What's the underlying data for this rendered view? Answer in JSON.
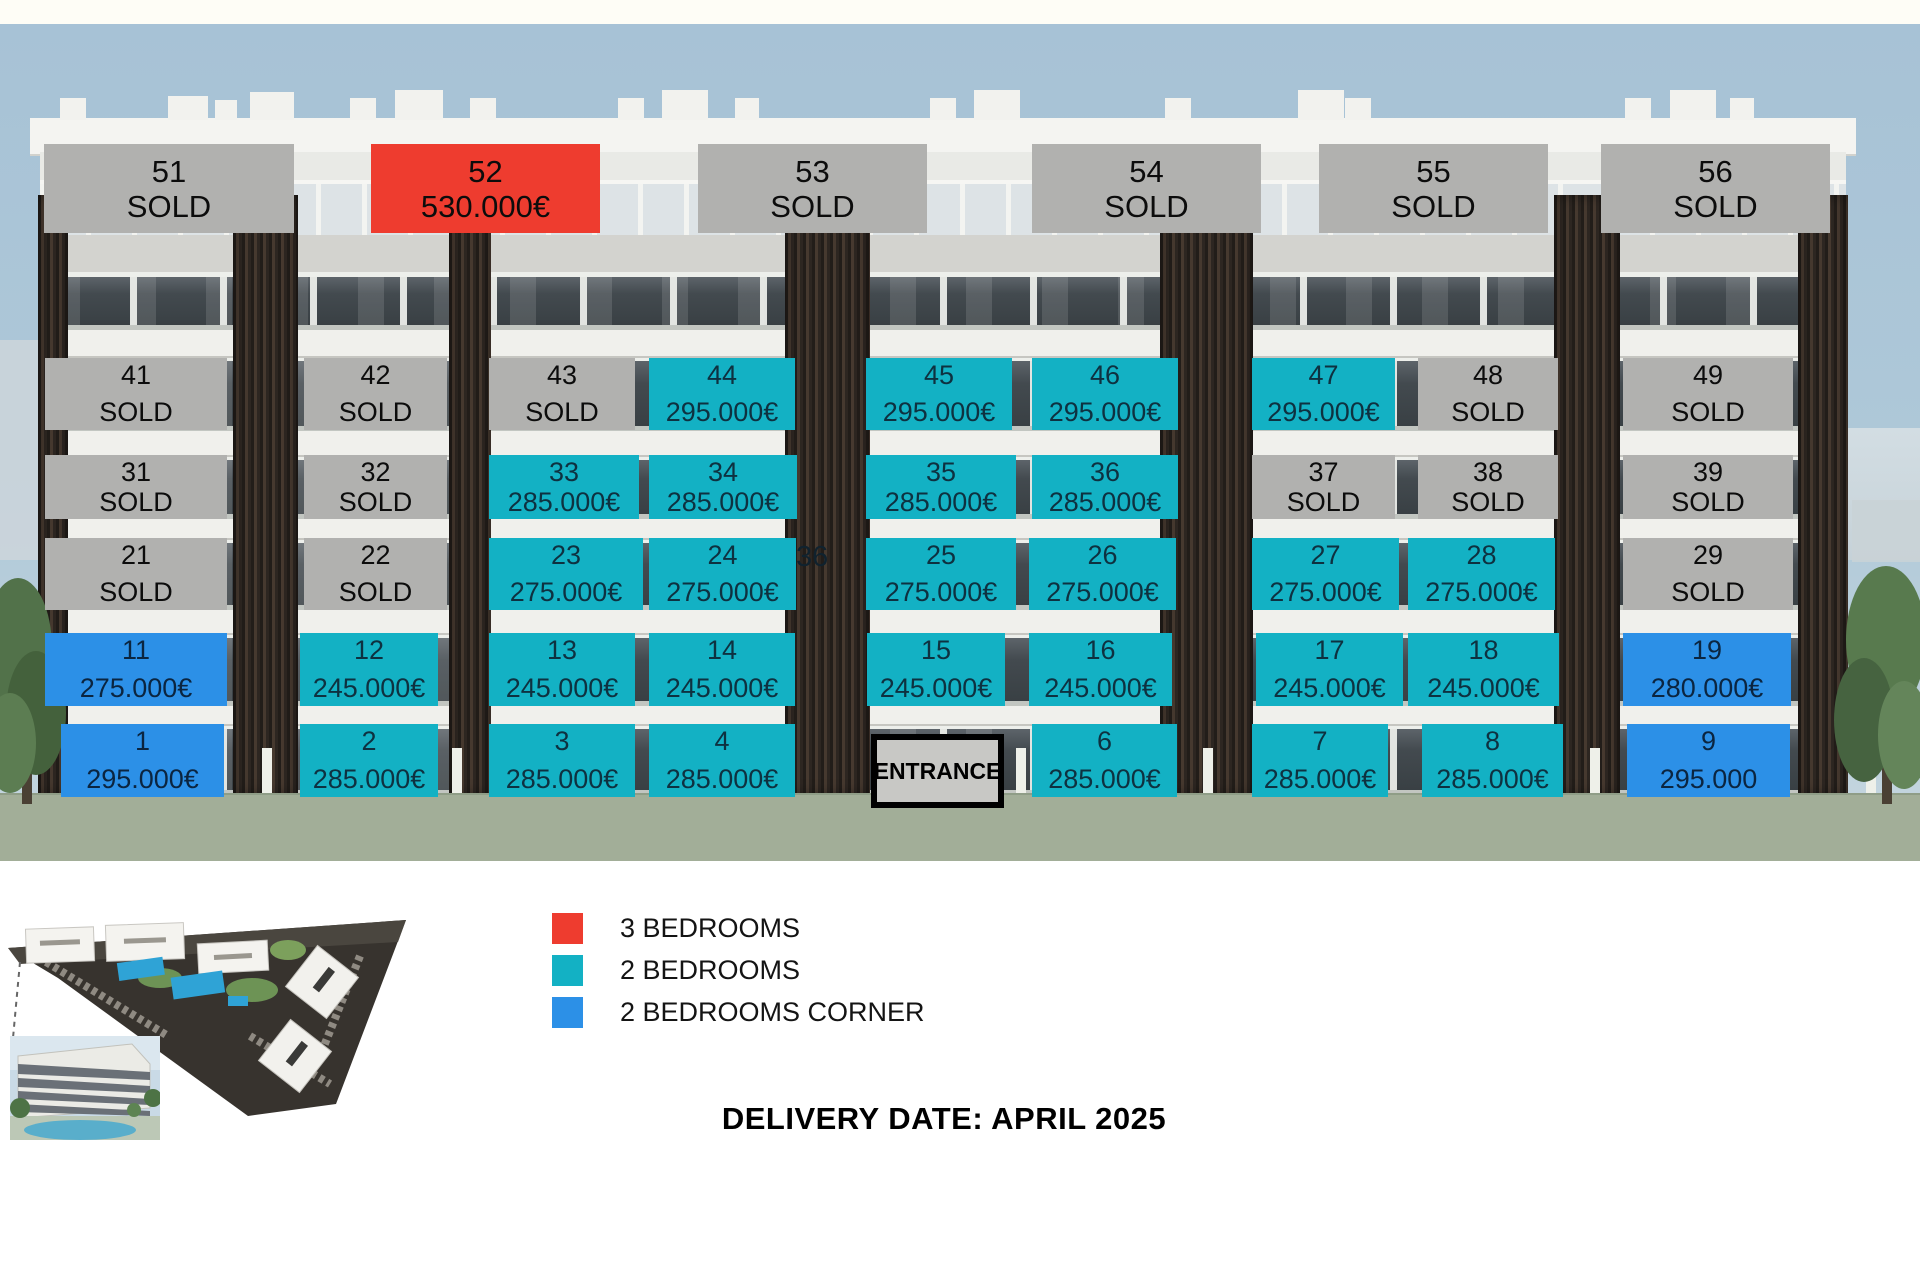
{
  "colors": {
    "sold_gray": "#b1b1af",
    "bed3_red": "#ee3c2f",
    "bed2_teal": "#13b1c4",
    "bed2corner_blue": "#2c90e7"
  },
  "building": {
    "rows": [
      {
        "name": "floor-5",
        "units": [
          {
            "id": "51",
            "text": "SOLD",
            "type": "sold",
            "x": 44,
            "y": 144,
            "w": 250,
            "h": 89
          },
          {
            "id": "52",
            "text": "530.000€",
            "type": "bed3",
            "x": 371,
            "y": 144,
            "w": 229,
            "h": 89
          },
          {
            "id": "53",
            "text": "SOLD",
            "type": "sold",
            "x": 698,
            "y": 144,
            "w": 229,
            "h": 89
          },
          {
            "id": "54",
            "text": "SOLD",
            "type": "sold",
            "x": 1032,
            "y": 144,
            "w": 229,
            "h": 89
          },
          {
            "id": "55",
            "text": "SOLD",
            "type": "sold",
            "x": 1319,
            "y": 144,
            "w": 229,
            "h": 89
          },
          {
            "id": "56",
            "text": "SOLD",
            "type": "sold",
            "x": 1601,
            "y": 144,
            "w": 229,
            "h": 89
          }
        ]
      },
      {
        "name": "floor-4",
        "units": [
          {
            "id": "41",
            "text": "SOLD",
            "type": "sold",
            "x": 45,
            "y": 358,
            "w": 182,
            "h": 72
          },
          {
            "id": "42",
            "text": "SOLD",
            "type": "sold",
            "x": 304,
            "y": 358,
            "w": 143,
            "h": 72
          },
          {
            "id": "43",
            "text": "SOLD",
            "type": "sold",
            "x": 489,
            "y": 358,
            "w": 146,
            "h": 72
          },
          {
            "id": "44",
            "text": "295.000€",
            "type": "bed2",
            "x": 649,
            "y": 358,
            "w": 146,
            "h": 72
          },
          {
            "id": "45",
            "text": "295.000€",
            "type": "bed2",
            "x": 866,
            "y": 358,
            "w": 146,
            "h": 72
          },
          {
            "id": "46",
            "text": "295.000€",
            "type": "bed2",
            "x": 1032,
            "y": 358,
            "w": 146,
            "h": 72
          },
          {
            "id": "47",
            "text": "295.000€",
            "type": "bed2",
            "x": 1252,
            "y": 358,
            "w": 143,
            "h": 72
          },
          {
            "id": "48",
            "text": "SOLD",
            "type": "sold",
            "x": 1418,
            "y": 358,
            "w": 140,
            "h": 72
          },
          {
            "id": "49",
            "text": "SOLD",
            "type": "sold",
            "x": 1623,
            "y": 358,
            "w": 170,
            "h": 72
          }
        ]
      },
      {
        "name": "floor-3",
        "units": [
          {
            "id": "31",
            "text": "SOLD",
            "type": "sold",
            "x": 45,
            "y": 455,
            "w": 182,
            "h": 64
          },
          {
            "id": "32",
            "text": "SOLD",
            "type": "sold",
            "x": 304,
            "y": 455,
            "w": 143,
            "h": 64
          },
          {
            "id": "33",
            "text": "285.000€",
            "type": "bed2",
            "x": 489,
            "y": 455,
            "w": 150,
            "h": 64
          },
          {
            "id": "34",
            "text": "285.000€",
            "type": "bed2",
            "x": 649,
            "y": 455,
            "w": 148,
            "h": 64
          },
          {
            "id": "35",
            "text": "285.000€",
            "type": "bed2",
            "x": 866,
            "y": 455,
            "w": 150,
            "h": 64
          },
          {
            "id": "36",
            "text": "285.000€",
            "type": "bed2",
            "x": 1032,
            "y": 455,
            "w": 146,
            "h": 64
          },
          {
            "id": "37",
            "text": "SOLD",
            "type": "sold",
            "x": 1252,
            "y": 455,
            "w": 143,
            "h": 64
          },
          {
            "id": "38",
            "text": "SOLD",
            "type": "sold",
            "x": 1418,
            "y": 455,
            "w": 140,
            "h": 64
          },
          {
            "id": "39",
            "text": "SOLD",
            "type": "sold",
            "x": 1623,
            "y": 455,
            "w": 170,
            "h": 64
          }
        ]
      },
      {
        "name": "floor-2",
        "units": [
          {
            "id": "21",
            "text": "SOLD",
            "type": "sold",
            "x": 45,
            "y": 538,
            "w": 182,
            "h": 72
          },
          {
            "id": "22",
            "text": "SOLD",
            "type": "sold",
            "x": 304,
            "y": 538,
            "w": 143,
            "h": 72
          },
          {
            "id": "23",
            "text": "275.000€",
            "type": "bed2",
            "x": 489,
            "y": 538,
            "w": 154,
            "h": 72
          },
          {
            "id": "24",
            "text": "275.000€",
            "type": "bed2",
            "x": 649,
            "y": 538,
            "w": 147,
            "h": 72
          },
          {
            "id": "25",
            "text": "275.000€",
            "type": "bed2",
            "x": 866,
            "y": 538,
            "w": 150,
            "h": 72
          },
          {
            "id": "26",
            "text": "275.000€",
            "type": "bed2",
            "x": 1029,
            "y": 538,
            "w": 147,
            "h": 72
          },
          {
            "id": "27",
            "text": "275.000€",
            "type": "bed2",
            "x": 1252,
            "y": 538,
            "w": 147,
            "h": 72
          },
          {
            "id": "28",
            "text": "275.000€",
            "type": "bed2",
            "x": 1408,
            "y": 538,
            "w": 147,
            "h": 72
          },
          {
            "id": "29",
            "text": "SOLD",
            "type": "sold",
            "x": 1623,
            "y": 538,
            "w": 170,
            "h": 72
          }
        ]
      },
      {
        "name": "floor-1",
        "units": [
          {
            "id": "11",
            "text": "275.000€",
            "type": "bed2corner",
            "x": 45,
            "y": 633,
            "w": 182,
            "h": 73
          },
          {
            "id": "12",
            "text": "245.000€",
            "type": "bed2",
            "x": 300,
            "y": 633,
            "w": 138,
            "h": 73
          },
          {
            "id": "13",
            "text": "245.000€",
            "type": "bed2",
            "x": 489,
            "y": 633,
            "w": 146,
            "h": 73
          },
          {
            "id": "14",
            "text": "245.000€",
            "type": "bed2",
            "x": 649,
            "y": 633,
            "w": 146,
            "h": 73
          },
          {
            "id": "15",
            "text": "245.000€",
            "type": "bed2",
            "x": 867,
            "y": 633,
            "w": 138,
            "h": 73
          },
          {
            "id": "16",
            "text": "245.000€",
            "type": "bed2",
            "x": 1029,
            "y": 633,
            "w": 143,
            "h": 73
          },
          {
            "id": "17",
            "text": "245.000€",
            "type": "bed2",
            "x": 1256,
            "y": 633,
            "w": 147,
            "h": 73
          },
          {
            "id": "18",
            "text": "245.000€",
            "type": "bed2",
            "x": 1408,
            "y": 633,
            "w": 151,
            "h": 73
          },
          {
            "id": "19",
            "text": "280.000€",
            "type": "bed2corner",
            "x": 1623,
            "y": 633,
            "w": 168,
            "h": 73
          }
        ]
      },
      {
        "name": "floor-0",
        "units": [
          {
            "id": "1",
            "text": "295.000€",
            "type": "bed2corner",
            "x": 61,
            "y": 724,
            "w": 163,
            "h": 73
          },
          {
            "id": "2",
            "text": "285.000€",
            "type": "bed2",
            "x": 300,
            "y": 724,
            "w": 138,
            "h": 73
          },
          {
            "id": "3",
            "text": "285.000€",
            "type": "bed2",
            "x": 489,
            "y": 724,
            "w": 146,
            "h": 73
          },
          {
            "id": "4",
            "text": "285.000€",
            "type": "bed2",
            "x": 649,
            "y": 724,
            "w": 146,
            "h": 73
          },
          {
            "id": "6",
            "text": "285.000€",
            "type": "bed2",
            "x": 1032,
            "y": 724,
            "w": 145,
            "h": 73
          },
          {
            "id": "7",
            "text": "285.000€",
            "type": "bed2",
            "x": 1252,
            "y": 724,
            "w": 136,
            "h": 73
          },
          {
            "id": "8",
            "text": "285.000€",
            "type": "bed2",
            "x": 1422,
            "y": 724,
            "w": 141,
            "h": 73
          },
          {
            "id": "9",
            "text": "295.000",
            "type": "bed2corner",
            "x": 1627,
            "y": 724,
            "w": 163,
            "h": 73
          }
        ]
      }
    ]
  },
  "entrance": {
    "label": "ENTRANCE",
    "x": 871,
    "y": 734,
    "w": 133,
    "h": 74
  },
  "floating_label": {
    "text": "36",
    "x": 796,
    "y": 541
  },
  "legend": {
    "items": [
      {
        "label": "3 BEDROOMS",
        "color": "#ee3c2f"
      },
      {
        "label": "2 BEDROOMS",
        "color": "#13b1c4"
      },
      {
        "label": "2 BEDROOMS CORNER",
        "color": "#2c90e7"
      }
    ]
  },
  "footer": {
    "delivery_text": "DELIVERY DATE: APRIL 2025"
  }
}
